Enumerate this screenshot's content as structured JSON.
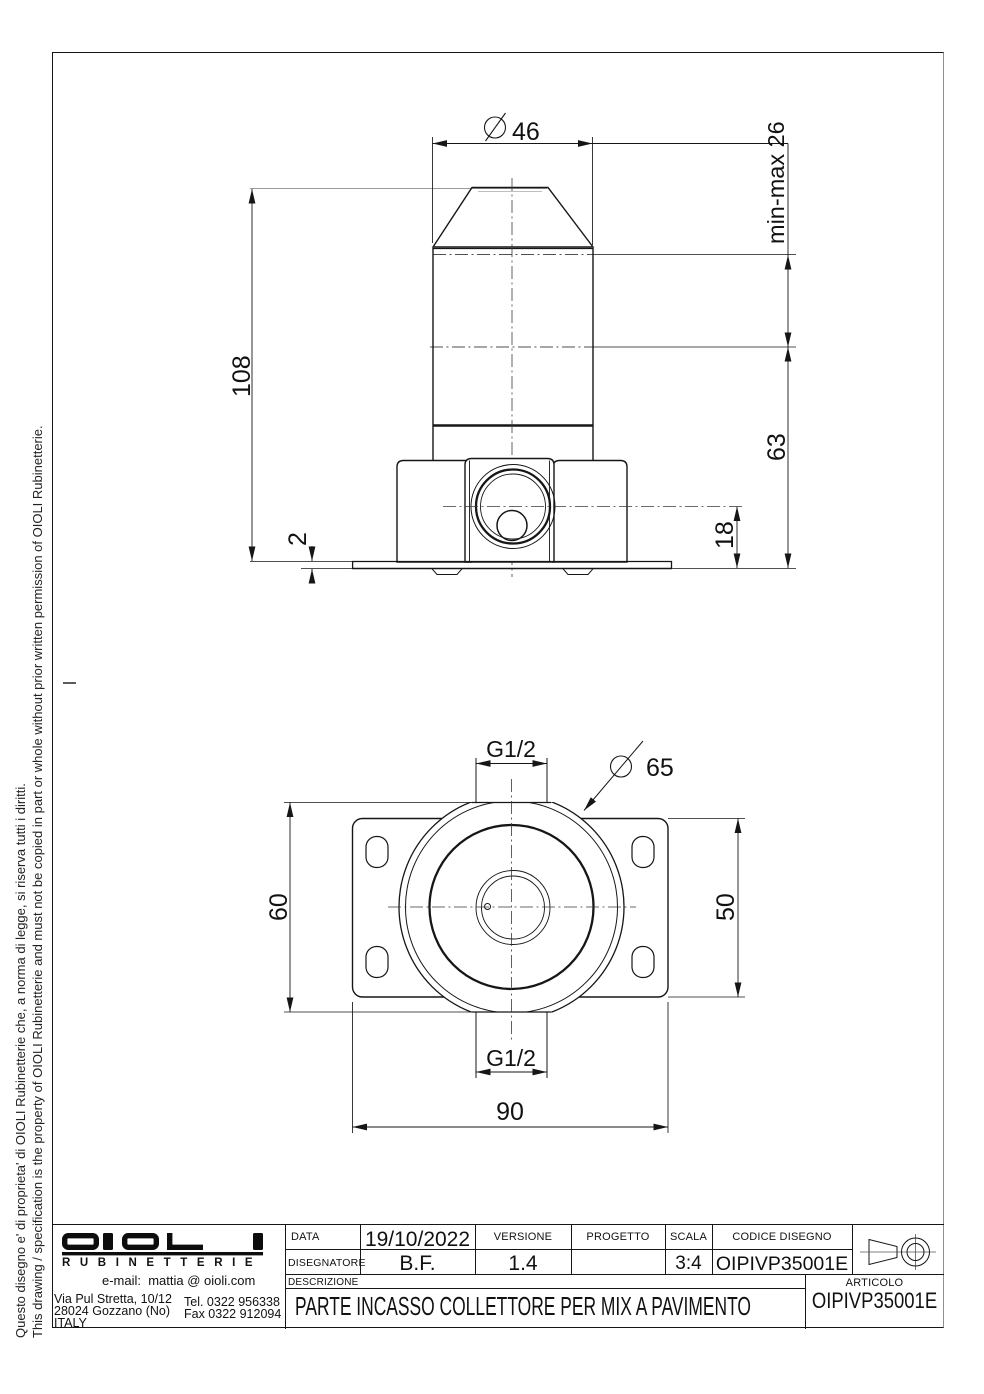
{
  "drawing": {
    "side_view": {
      "dia_top": "46",
      "height_total": "108",
      "plate_thickness": "2",
      "min_max_label": "min-max 26",
      "depth_below": "63",
      "axis_to_base": "18"
    },
    "front_view": {
      "thread_top": "G1/2",
      "thread_bottom": "G1/2",
      "dia_body": "65",
      "flat_to_flat": "60",
      "plate_height": "50",
      "plate_width": "90"
    }
  },
  "title_block": {
    "labels": {
      "data": "DATA",
      "disegnatore": "DISEGNATORE",
      "versione": "VERSIONE",
      "progetto": "PROGETTO",
      "scala": "SCALA",
      "codice": "CODICE DISEGNO",
      "descrizione": "DESCRIZIONE",
      "articolo": "ARTICOLO"
    },
    "values": {
      "data": "19/10/2022",
      "disegnatore": "B.F.",
      "versione": "1.4",
      "progetto": "",
      "scala": "3:4",
      "codice": "OIPIVP35001E",
      "descrizione": "PARTE INCASSO COLLETTORE PER MIX A PAVIMENTO",
      "articolo": "OIPIVP35001E"
    }
  },
  "company": {
    "brand": "OIOLI",
    "brand_sub": "RUBINETTERIE",
    "email": "e-mail:  mattia @ oioli.com",
    "address1": "Via Pul Stretta, 10/12",
    "address2": "28024 Gozzano (No)",
    "address3": "ITALY",
    "tel": "Tel. 0322 956338",
    "fax": "Fax 0322 912094"
  },
  "copyright": {
    "italian": "Questo disegno e' di proprieta' di OIOLI Rubinetterie che, a norma di legge, si riserva tutti i diritti.",
    "english": "This drawing / specification is the property of OIOLI Rubinetterie and must not be copied in part or whole without prior written permission of OIOLI Rubinetterie."
  }
}
